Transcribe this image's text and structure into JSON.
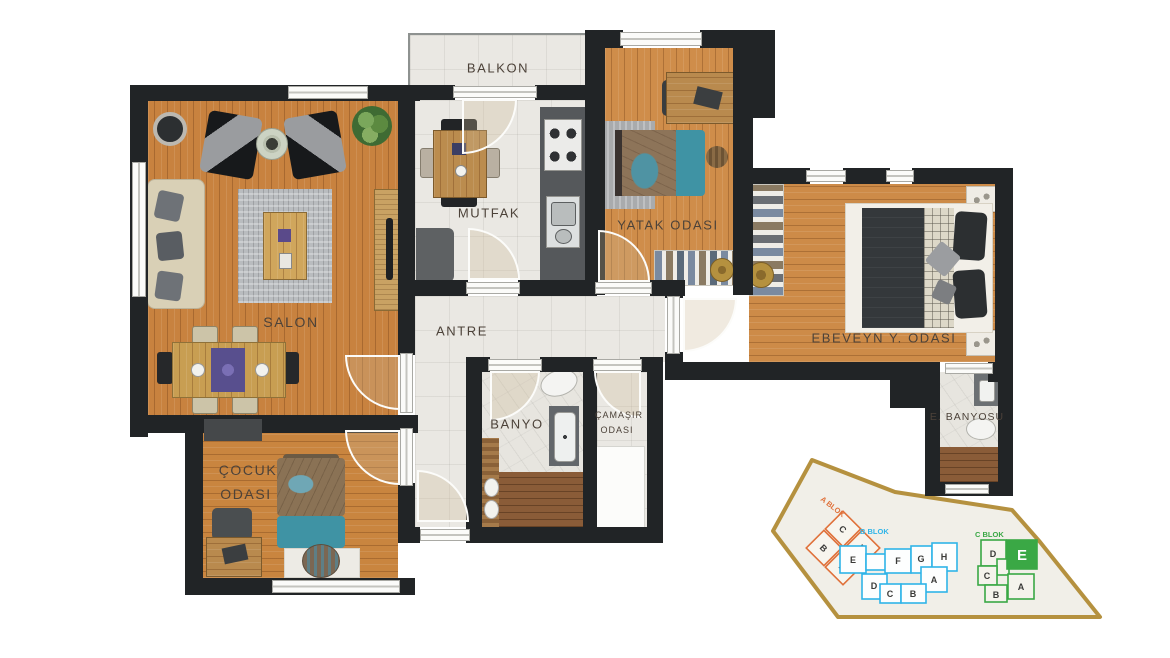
{
  "rooms": {
    "balkon": {
      "label": "BALKON"
    },
    "mutfak": {
      "label": "MUTFAK"
    },
    "salon": {
      "label": "SALON"
    },
    "yatak": {
      "label": "YATAK ODASI"
    },
    "ebeveyn": {
      "label": "EBEVEYN Y. ODASI"
    },
    "antre": {
      "label": "ANTRE"
    },
    "banyo": {
      "label": "BANYO"
    },
    "camasir": {
      "line1": "ÇAMAŞIR",
      "line2": "ODASI"
    },
    "cocuk": {
      "line1": "ÇOCUK",
      "line2": "ODASI"
    },
    "e_banyosu": {
      "label": "E. BANYOSU"
    }
  },
  "siteplan": {
    "boundary_color": "#b5913f",
    "blocks": [
      {
        "name": "A BLOK",
        "color": "#e0713a",
        "units": [
          "C",
          "D",
          "B",
          "A"
        ]
      },
      {
        "name": "B BLOK",
        "color": "#2fb4e8",
        "units": [
          "E",
          "F",
          "G",
          "H",
          "D",
          "C",
          "B",
          "A"
        ]
      },
      {
        "name": "C BLOK",
        "color": "#3aa845",
        "units": [
          "D",
          "E",
          "C",
          "B",
          "A"
        ],
        "highlighted_unit": "E"
      }
    ]
  },
  "colors": {
    "wall": "#212426",
    "wood_floor": "#c8823f",
    "tile_floor": "#eae8e3",
    "highlight_green": "#3aa845",
    "accent_teal": "#3f93a4"
  }
}
